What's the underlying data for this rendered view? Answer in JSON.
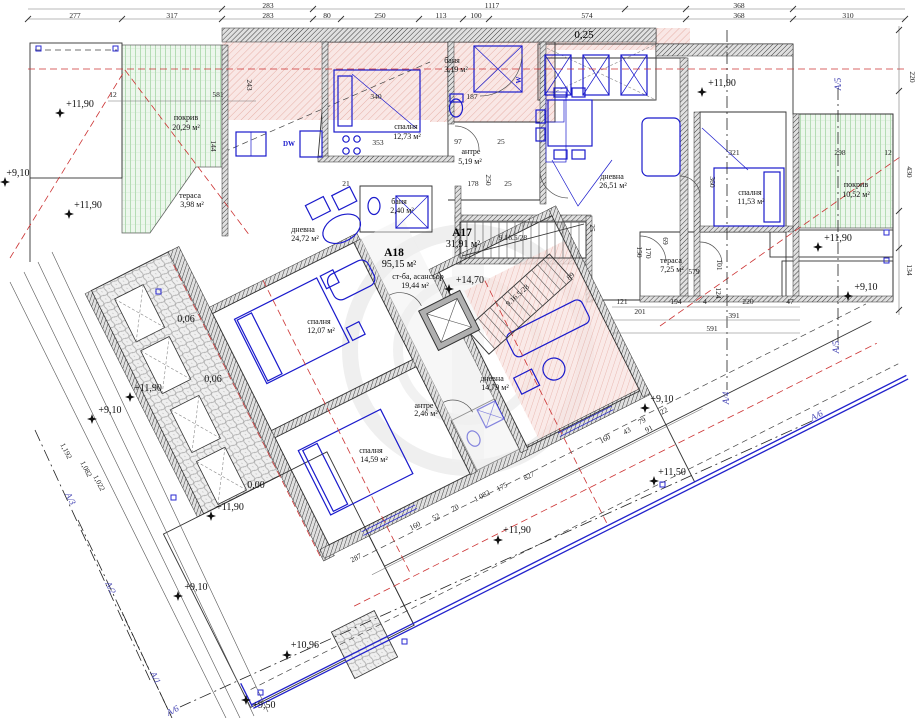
{
  "drawing": {
    "type": "architectural floor plan",
    "language": "bg"
  },
  "colors": {
    "roof_green_fill": "#edf7ed",
    "roof_green_line": "#86c786",
    "hatch_pink_fill": "#f8e3e0",
    "hatch_pink_line": "#dd9186",
    "wall_fill": "#e0e0e0",
    "wall_line": "#3c3c3c",
    "furniture_blue": "#1a1acc",
    "axis_blue": "#4646b4",
    "red_dashed": "#cc3333",
    "bottom_edge_blue": "#2222cc"
  },
  "labels": [
    {
      "t": "283",
      "x": 268,
      "y": 8,
      "c": "dim"
    },
    {
      "t": "1117",
      "x": 492,
      "y": 8,
      "c": "dim"
    },
    {
      "t": "368",
      "x": 739,
      "y": 8,
      "c": "dim"
    },
    {
      "t": "277",
      "x": 75,
      "y": 18,
      "c": "dim"
    },
    {
      "t": "317",
      "x": 172,
      "y": 18,
      "c": "dim"
    },
    {
      "t": "283",
      "x": 268,
      "y": 18,
      "c": "dim"
    },
    {
      "t": "80",
      "x": 327,
      "y": 18,
      "c": "dim"
    },
    {
      "t": "250",
      "x": 380,
      "y": 18,
      "c": "dim"
    },
    {
      "t": "113",
      "x": 441,
      "y": 18,
      "c": "dim"
    },
    {
      "t": "100",
      "x": 476,
      "y": 18,
      "c": "dim"
    },
    {
      "t": "574",
      "x": 587,
      "y": 18,
      "c": "dim"
    },
    {
      "t": "368",
      "x": 739,
      "y": 18,
      "c": "dim"
    },
    {
      "t": "310",
      "x": 848,
      "y": 18,
      "c": "dim"
    },
    {
      "t": "0,25",
      "x": 584,
      "y": 38,
      "c": "note"
    },
    {
      "t": "220",
      "x": 910,
      "y": 77,
      "r": 90,
      "c": "dim"
    },
    {
      "t": "430",
      "x": 907,
      "y": 172,
      "r": 90,
      "c": "dim"
    },
    {
      "t": "134",
      "x": 907,
      "y": 270,
      "r": 90,
      "c": "dim"
    },
    {
      "t": "12",
      "x": 113,
      "y": 97,
      "c": "dim"
    },
    {
      "t": "581",
      "x": 218,
      "y": 97,
      "c": "dim"
    },
    {
      "t": "243",
      "x": 247,
      "y": 85,
      "r": 90,
      "c": "dim"
    },
    {
      "t": "144",
      "x": 211,
      "y": 146,
      "r": 90,
      "c": "dim"
    },
    {
      "t": "340",
      "x": 376,
      "y": 99,
      "c": "dim"
    },
    {
      "t": "187",
      "x": 472,
      "y": 99,
      "c": "dim"
    },
    {
      "t": "97",
      "x": 458,
      "y": 144,
      "c": "dim"
    },
    {
      "t": "25",
      "x": 501,
      "y": 144,
      "c": "dim"
    },
    {
      "t": "353",
      "x": 378,
      "y": 145,
      "c": "dim"
    },
    {
      "t": "21",
      "x": 346,
      "y": 186,
      "c": "dim"
    },
    {
      "t": "178",
      "x": 473,
      "y": 186,
      "c": "dim"
    },
    {
      "t": "250",
      "x": 486,
      "y": 180,
      "r": 90,
      "c": "dim"
    },
    {
      "t": "25",
      "x": 508,
      "y": 186,
      "c": "dim"
    },
    {
      "t": "321",
      "x": 734,
      "y": 155,
      "c": "dim"
    },
    {
      "t": "298",
      "x": 840,
      "y": 155,
      "c": "dim"
    },
    {
      "t": "12",
      "x": 888,
      "y": 155,
      "c": "dim"
    },
    {
      "t": "360",
      "x": 710,
      "y": 182,
      "r": 90,
      "c": "dim"
    },
    {
      "t": "69",
      "x": 663,
      "y": 241,
      "r": 90,
      "c": "dim"
    },
    {
      "t": "170",
      "x": 646,
      "y": 253,
      "r": 90,
      "c": "dim"
    },
    {
      "t": "101",
      "x": 717,
      "y": 265,
      "r": 90,
      "c": "dim"
    },
    {
      "t": "124",
      "x": 716,
      "y": 293,
      "r": 90,
      "c": "dim"
    },
    {
      "t": "579",
      "x": 694,
      "y": 274,
      "c": "dim"
    },
    {
      "t": "121",
      "x": 622,
      "y": 304,
      "c": "dim"
    },
    {
      "t": "194",
      "x": 676,
      "y": 304,
      "c": "dim"
    },
    {
      "t": "4",
      "x": 705,
      "y": 304,
      "c": "dim"
    },
    {
      "t": "220",
      "x": 748,
      "y": 304,
      "c": "dim"
    },
    {
      "t": "47",
      "x": 790,
      "y": 304,
      "c": "dim"
    },
    {
      "t": "201",
      "x": 640,
      "y": 314,
      "c": "dim"
    },
    {
      "t": "391",
      "x": 734,
      "y": 318,
      "c": "dim"
    },
    {
      "t": "591",
      "x": 712,
      "y": 331,
      "c": "dim"
    },
    {
      "t": "150",
      "x": 637,
      "y": 252,
      "r": 90,
      "c": "dim"
    },
    {
      "t": "25",
      "x": 590,
      "y": 228,
      "r": 90,
      "c": "dim"
    },
    {
      "t": "89",
      "x": 572,
      "y": 278,
      "r": -40,
      "c": "dim"
    },
    {
      "t": "9.16.5/28",
      "x": 513,
      "y": 240,
      "c": "dim"
    },
    {
      "t": "9.16.5/28",
      "x": 519,
      "y": 297,
      "r": -42,
      "c": "dim"
    },
    {
      "t": "287",
      "x": 357,
      "y": 560,
      "r": -27,
      "c": "dim"
    },
    {
      "t": "160",
      "x": 416,
      "y": 528,
      "r": -27,
      "c": "dim"
    },
    {
      "t": "52",
      "x": 437,
      "y": 519,
      "r": -27,
      "c": "dim"
    },
    {
      "t": "70",
      "x": 456,
      "y": 510,
      "r": -27,
      "c": "dim"
    },
    {
      "t": "1 082",
      "x": 483,
      "y": 498,
      "r": -27,
      "c": "dim"
    },
    {
      "t": "175",
      "x": 503,
      "y": 489,
      "r": -27,
      "c": "dim"
    },
    {
      "t": "827",
      "x": 530,
      "y": 478,
      "r": -27,
      "c": "dim"
    },
    {
      "t": "22",
      "x": 665,
      "y": 413,
      "r": -27,
      "c": "dim"
    },
    {
      "t": "79",
      "x": 643,
      "y": 423,
      "r": -27,
      "c": "dim"
    },
    {
      "t": "91",
      "x": 650,
      "y": 431,
      "r": -27,
      "c": "dim"
    },
    {
      "t": "43",
      "x": 628,
      "y": 433,
      "r": -27,
      "c": "dim"
    },
    {
      "t": "160",
      "x": 606,
      "y": 441,
      "r": -27,
      "c": "dim"
    },
    {
      "t": "1,192",
      "x": 64,
      "y": 452,
      "r": 63,
      "c": "dim"
    },
    {
      "t": "1,082",
      "x": 84,
      "y": 470,
      "r": 63,
      "c": "dim"
    },
    {
      "t": "1,022",
      "x": 97,
      "y": 484,
      "r": 63,
      "c": "dim"
    },
    {
      "t": "покрив",
      "x": 186,
      "y": 120,
      "c": "room"
    },
    {
      "t": "20,29 м²",
      "x": 186,
      "y": 130,
      "c": "room"
    },
    {
      "t": "покрив",
      "x": 856,
      "y": 187,
      "c": "room"
    },
    {
      "t": "10,52 м²",
      "x": 856,
      "y": 197,
      "c": "room"
    },
    {
      "t": "спалня",
      "x": 406,
      "y": 129,
      "c": "room"
    },
    {
      "t": "12,73 м²",
      "x": 407,
      "y": 139,
      "c": "room"
    },
    {
      "t": "баня",
      "x": 452,
      "y": 63,
      "c": "room"
    },
    {
      "t": "3,19 м²",
      "x": 456,
      "y": 72,
      "c": "room"
    },
    {
      "t": "антре",
      "x": 471,
      "y": 154,
      "c": "room"
    },
    {
      "t": "5,19 м²",
      "x": 470,
      "y": 164,
      "c": "room"
    },
    {
      "t": "баня",
      "x": 399,
      "y": 204,
      "c": "room"
    },
    {
      "t": "2,40 м²",
      "x": 402,
      "y": 213,
      "c": "room"
    },
    {
      "t": "дневна",
      "x": 612,
      "y": 179,
      "c": "room"
    },
    {
      "t": "26,51 м²",
      "x": 613,
      "y": 188,
      "c": "room"
    },
    {
      "t": "спалня",
      "x": 750,
      "y": 195,
      "c": "room"
    },
    {
      "t": "11,53 м²",
      "x": 751,
      "y": 204,
      "c": "room"
    },
    {
      "t": "тераса",
      "x": 671,
      "y": 263,
      "c": "room"
    },
    {
      "t": "7,25 м²",
      "x": 672,
      "y": 272,
      "c": "room"
    },
    {
      "t": "тераса",
      "x": 190,
      "y": 198,
      "c": "room"
    },
    {
      "t": "3,98 м²",
      "x": 192,
      "y": 207,
      "c": "room"
    },
    {
      "t": "дневна",
      "x": 303,
      "y": 232,
      "c": "room"
    },
    {
      "t": "24,72 м²",
      "x": 305,
      "y": 241,
      "c": "room"
    },
    {
      "t": "спалня",
      "x": 319,
      "y": 324,
      "c": "room"
    },
    {
      "t": "12,07 м²",
      "x": 321,
      "y": 333,
      "c": "room"
    },
    {
      "t": "спалня",
      "x": 371,
      "y": 453,
      "c": "room"
    },
    {
      "t": "14,59 м²",
      "x": 374,
      "y": 462,
      "c": "room"
    },
    {
      "t": "дневна",
      "x": 492,
      "y": 381,
      "c": "room"
    },
    {
      "t": "14,79 м²",
      "x": 495,
      "y": 390,
      "c": "room"
    },
    {
      "t": "антре",
      "x": 424,
      "y": 408,
      "c": "room"
    },
    {
      "t": "2,46 м²",
      "x": 426,
      "y": 416,
      "c": "room"
    },
    {
      "t": "ст-ба, асансьор",
      "x": 418,
      "y": 279,
      "c": "room"
    },
    {
      "t": "19,44 м²",
      "x": 415,
      "y": 288,
      "c": "room"
    },
    {
      "t": "A18",
      "x": 394,
      "y": 256,
      "c": "apt"
    },
    {
      "t": "95,15 м²",
      "x": 399,
      "y": 267,
      "c": "apt2"
    },
    {
      "t": "A17",
      "x": 462,
      "y": 236,
      "c": "apt"
    },
    {
      "t": "31,91 м²",
      "x": 463,
      "y": 247,
      "c": "apt2"
    },
    {
      "t": "+11,90",
      "x": 80,
      "y": 107,
      "c": "elev"
    },
    {
      "t": "+9,10",
      "x": 18,
      "y": 176,
      "c": "elev"
    },
    {
      "t": "+11,90",
      "x": 88,
      "y": 208,
      "c": "elev"
    },
    {
      "t": "+11,90",
      "x": 722,
      "y": 86,
      "c": "elev"
    },
    {
      "t": "+11,90",
      "x": 838,
      "y": 241,
      "c": "elev"
    },
    {
      "t": "+9,10",
      "x": 866,
      "y": 290,
      "c": "elev"
    },
    {
      "t": "+14,70",
      "x": 470,
      "y": 283,
      "c": "elev"
    },
    {
      "t": "+11,90",
      "x": 148,
      "y": 391,
      "c": "elev"
    },
    {
      "t": "+9,10",
      "x": 110,
      "y": 413,
      "c": "elev"
    },
    {
      "t": "+11,90",
      "x": 230,
      "y": 510,
      "c": "elev"
    },
    {
      "t": "+9,10",
      "x": 196,
      "y": 590,
      "c": "elev"
    },
    {
      "t": "+9,50",
      "x": 264,
      "y": 708,
      "c": "elev"
    },
    {
      "t": "+10,96",
      "x": 305,
      "y": 648,
      "c": "elev"
    },
    {
      "t": "+11,50",
      "x": 672,
      "y": 475,
      "c": "elev"
    },
    {
      "t": "+9,10",
      "x": 662,
      "y": 402,
      "c": "elev"
    },
    {
      "t": "+11,90",
      "x": 517,
      "y": 533,
      "c": "elev"
    },
    {
      "t": "0,06",
      "x": 186,
      "y": 322,
      "c": "elev"
    },
    {
      "t": "0,06",
      "x": 213,
      "y": 382,
      "c": "elev"
    },
    {
      "t": "0,00",
      "x": 256,
      "y": 488,
      "c": "elev"
    },
    {
      "t": "А/5",
      "x": 841,
      "y": 84,
      "r": -90,
      "c": "axis"
    },
    {
      "t": "А/5",
      "x": 839,
      "y": 347,
      "r": -90,
      "c": "axis"
    },
    {
      "t": "А/4",
      "x": 729,
      "y": 398,
      "r": -90,
      "c": "axis"
    },
    {
      "t": "А/6",
      "x": 818,
      "y": 418,
      "r": -27,
      "c": "axis"
    },
    {
      "t": "А/6",
      "x": 174,
      "y": 713,
      "r": -27,
      "c": "axis"
    },
    {
      "t": "А/3",
      "x": 68,
      "y": 500,
      "r": 63,
      "c": "axis"
    },
    {
      "t": "А/2",
      "x": 108,
      "y": 589,
      "r": 63,
      "c": "axis"
    },
    {
      "t": "А/1",
      "x": 153,
      "y": 679,
      "r": 63,
      "c": "axis"
    },
    {
      "t": "DW",
      "x": 289,
      "y": 146,
      "c": "blue"
    },
    {
      "t": "W",
      "x": 521,
      "y": 80,
      "r": -90,
      "c": "blue"
    }
  ],
  "stars": [
    {
      "x": 60,
      "y": 113
    },
    {
      "x": 5,
      "y": 182
    },
    {
      "x": 69,
      "y": 214
    },
    {
      "x": 702,
      "y": 92
    },
    {
      "x": 818,
      "y": 247
    },
    {
      "x": 848,
      "y": 296
    },
    {
      "x": 449,
      "y": 289
    },
    {
      "x": 130,
      "y": 397
    },
    {
      "x": 92,
      "y": 419
    },
    {
      "x": 211,
      "y": 516
    },
    {
      "x": 178,
      "y": 596
    },
    {
      "x": 246,
      "y": 700
    },
    {
      "x": 287,
      "y": 655
    },
    {
      "x": 654,
      "y": 481
    },
    {
      "x": 645,
      "y": 408
    },
    {
      "x": 498,
      "y": 540
    }
  ]
}
